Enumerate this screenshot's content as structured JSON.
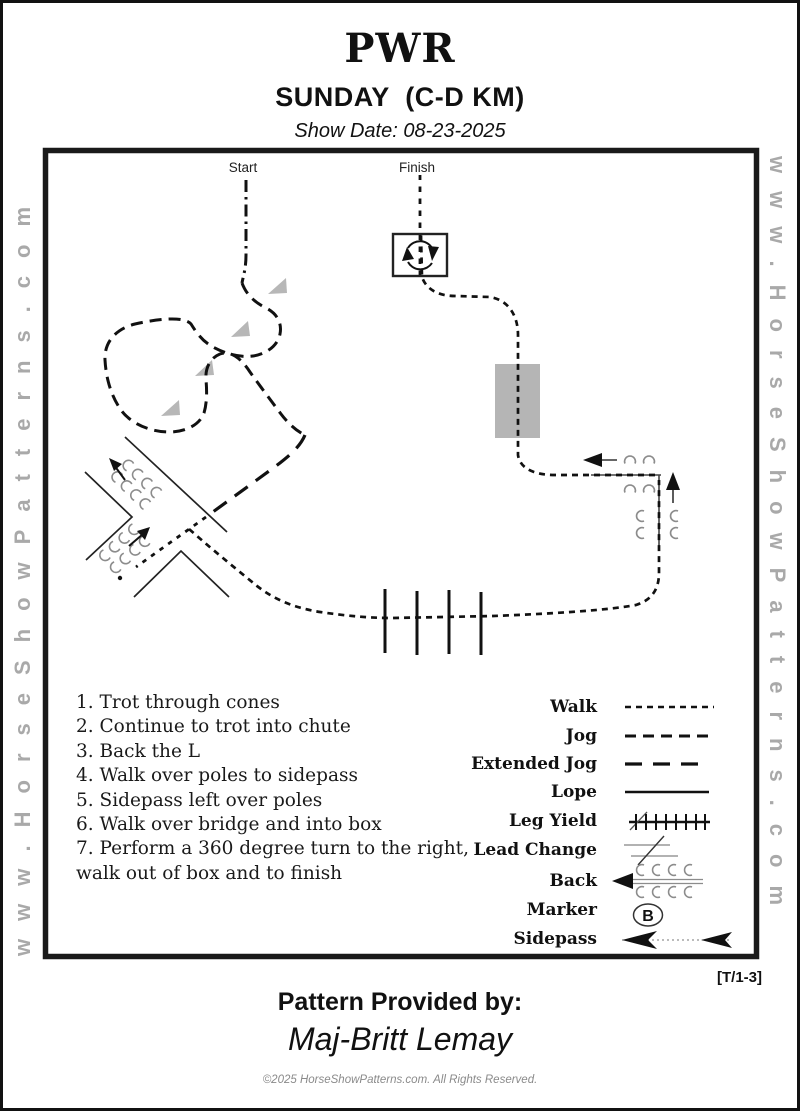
{
  "header": {
    "title": "PWR",
    "subtitle": "SUNDAY  (C-D KM)",
    "show_date": "Show Date: 08-23-2025"
  },
  "watermark": {
    "left_text": "www.HorseShowPatterns.com",
    "right_text": "www.HorseShowPatterns.com"
  },
  "course": {
    "start_label": "Start",
    "finish_label": "Finish"
  },
  "instructions": [
    "1. Trot through cones",
    "2. Continue to trot into chute",
    "3. Back the L",
    "4. Walk over poles to sidepass",
    "5. Sidepass left over poles",
    "6. Walk over bridge and into box",
    "7. Perform a 360 degree turn to the right, walk out of box and to finish"
  ],
  "legend": {
    "items": [
      {
        "label": "Walk"
      },
      {
        "label": "Jog"
      },
      {
        "label": "Extended Jog"
      },
      {
        "label": "Lope"
      },
      {
        "label": "Leg Yield"
      },
      {
        "label": "Lead Change"
      },
      {
        "label": "Back"
      },
      {
        "label": "Marker"
      },
      {
        "label": "Sidepass"
      }
    ],
    "marker_letter": "B"
  },
  "footer": {
    "pattern_ref": "[T/1-3]",
    "provided_by": "Pattern Provided by:",
    "provider_name": "Maj-Britt Lemay",
    "copyright": "©2025 HorseShowPatterns.com. All Rights Reserved."
  },
  "colors": {
    "ink": "#111111",
    "gray_fill": "#b5b5b5",
    "watermark_gray": "#a9a9a9",
    "hoof_gray": "#8c8c8c"
  }
}
